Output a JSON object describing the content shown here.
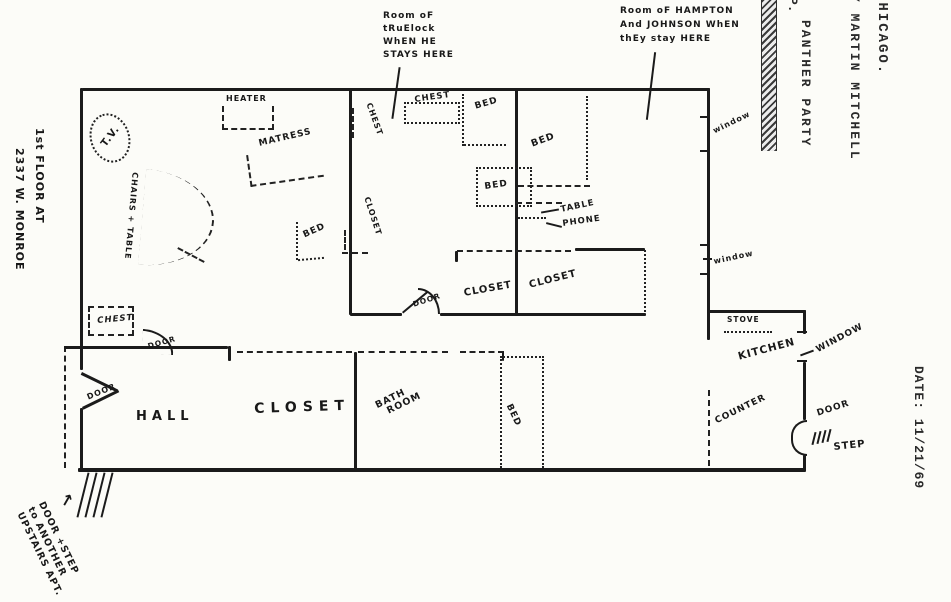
{
  "margin_right": {
    "city": "CHICAGO.",
    "byline": "Y MARTIN MITCHELL",
    "party": "PANTHER PARTY",
    "fragment": "P.",
    "date_label": "DATE:  11/21/69"
  },
  "margin_left": {
    "line1": "1st FLOOR AT",
    "line2": "2337 W. MONROE"
  },
  "note_bottom_left": {
    "arrow": "↑",
    "line1": "DOOR +STEP",
    "line2": "to ANOTHER",
    "line3": "UPSTAIRS APT."
  },
  "annotations": {
    "truelock": [
      "Room oF",
      "tRuElock",
      "WhEN HE",
      "STAYS HERE"
    ],
    "hampton": [
      "Room oF HAMPTON",
      "And JOHNSON WhEN",
      "thEy stay HERE"
    ]
  },
  "labels": {
    "tv": "T.V.",
    "heater": "HEATER",
    "matress": "MATRESS",
    "chairs_table": "CHAIRS + TABLE",
    "bed": "BED",
    "chest": "CHEST",
    "closet": "CLOSET",
    "table": "TABLE",
    "phone": "PHONE",
    "door": "DOOR",
    "hall": "HALL",
    "bath_line1": "BATH",
    "bath_line2": "ROOM",
    "stove": "STOVE",
    "kitchen": "KITCHEN",
    "window_caps": "WINDOW",
    "window": "window",
    "counter": "COUNTER",
    "step": "STEP"
  },
  "ink": "#1b1b1b"
}
